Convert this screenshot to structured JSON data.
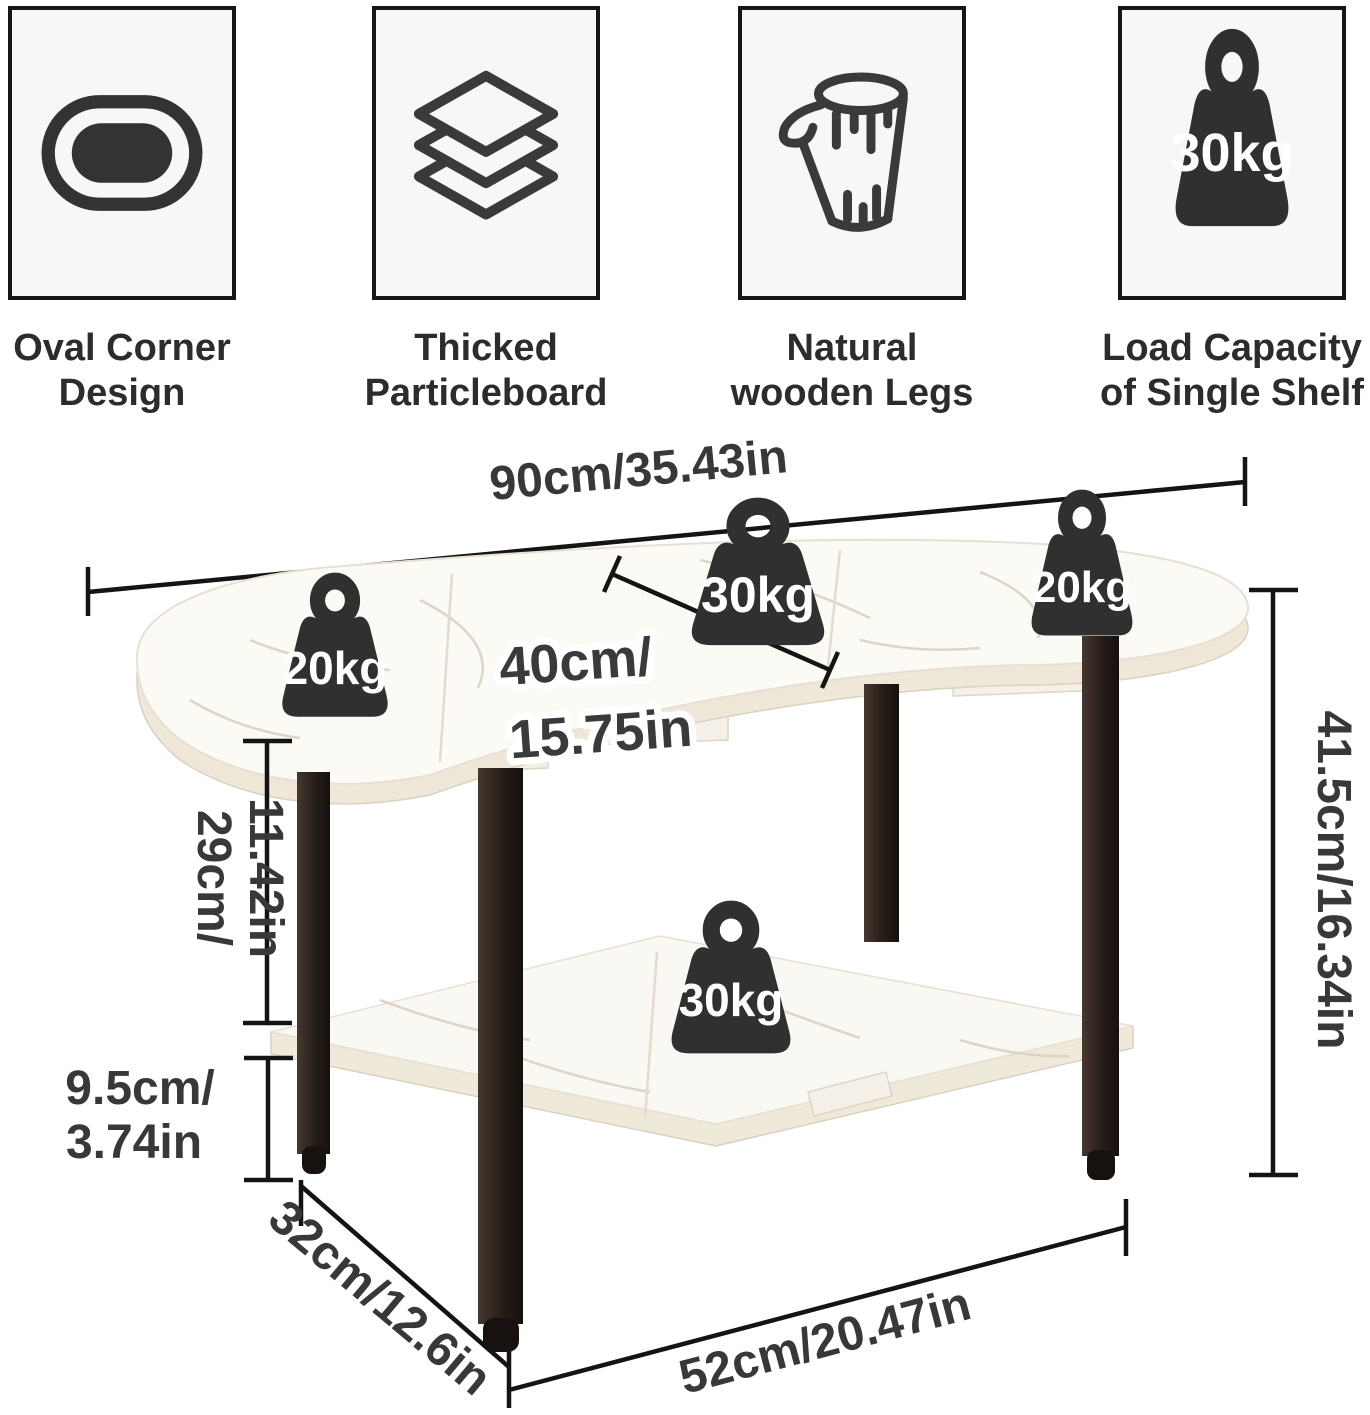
{
  "features": [
    {
      "icon": "oval-corner-icon",
      "line1": "Oval Corner",
      "line2": "Design"
    },
    {
      "icon": "particleboard-layers-icon",
      "line1": "Thicked",
      "line2": "Particleboard"
    },
    {
      "icon": "wood-log-icon",
      "line1": "Natural",
      "line2": "wooden Legs"
    },
    {
      "icon": "load-weight-icon",
      "badge": "30kg",
      "line1": "Load Capacity",
      "line2": "of Single Shelf"
    }
  ],
  "diagram": {
    "weights": {
      "top_left": "20kg",
      "top_center": "30kg",
      "top_right": "20kg",
      "shelf": "30kg"
    },
    "dimensions": {
      "top_length": "90cm/35.43in",
      "extension_width_line1": "40cm/",
      "extension_width_line2": "15.75in",
      "top_to_shelf_line1": "29cm/",
      "top_to_shelf_line2": "11.42in",
      "shelf_clearance_line1": "9.5cm/",
      "shelf_clearance_line2": "3.74in",
      "depth": "32cm/12.6in",
      "shelf_length": "52cm/20.47in",
      "total_height": "41.5cm/16.34in"
    }
  },
  "colors": {
    "ink": "#141414",
    "dimension_text": "#383838",
    "weight_fill": "#303030",
    "top_surface": "#fbfaf5",
    "top_edge": "#efe8d9",
    "shelf_surface": "#faf8f2",
    "leg_dark": "#241c16",
    "card_background": "#f7f7f5",
    "card_border": "#161616"
  }
}
